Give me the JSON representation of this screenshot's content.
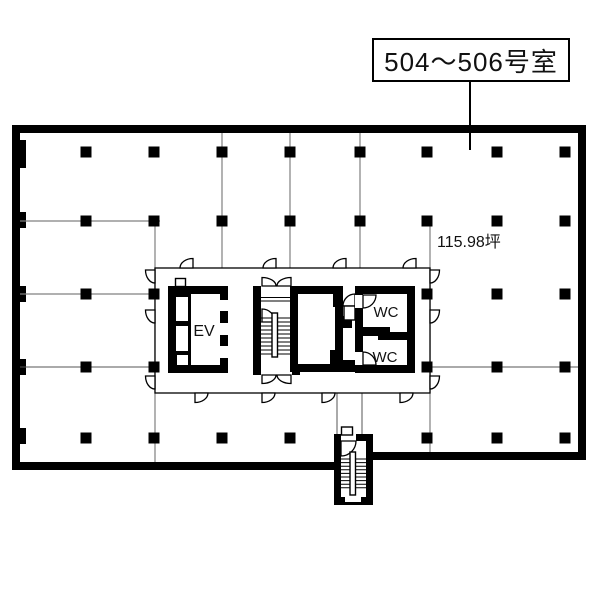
{
  "label": {
    "text": "504〜506号室"
  },
  "plan": {
    "area_text": "115.98坪",
    "rooms": {
      "elevator": "EV",
      "wc_top": "WC",
      "wc_bottom": "WC"
    },
    "colors": {
      "wall": "#000000",
      "grid": "#808080",
      "floor": "#ffffff"
    }
  }
}
